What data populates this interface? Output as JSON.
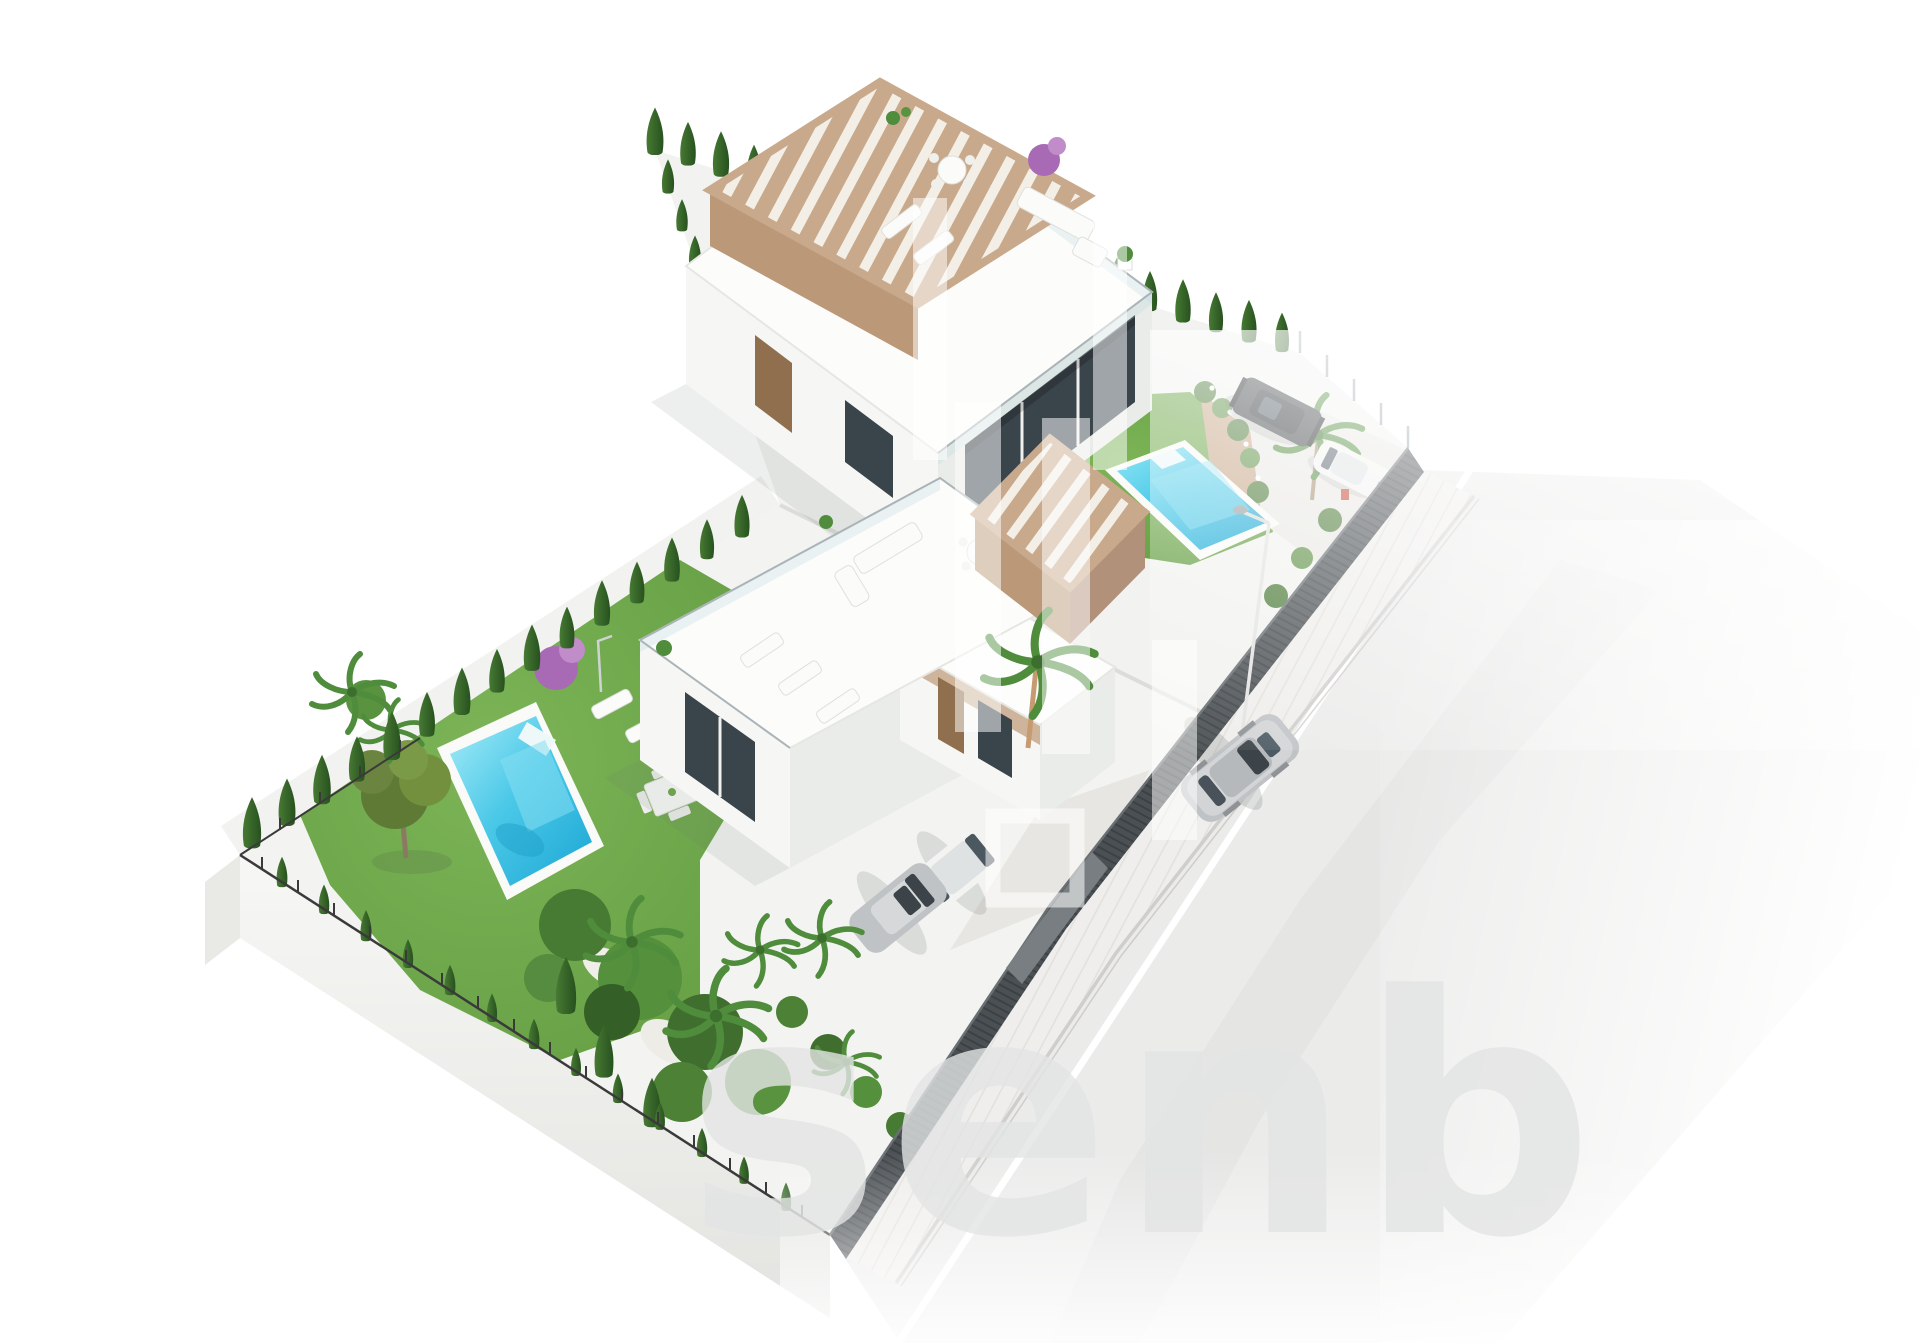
{
  "image": {
    "type": "3d-architectural-aerial-render",
    "description": "Isometric aerial render of an L-shaped plot with two modern white villas, each with roof terrace and wooden pergola, private pools, green lawns, cypress hedges, parked cars and a street running along the plot",
    "width": 1920,
    "height": 1343
  },
  "watermark": {
    "visible_letters": "senb"
  },
  "colors": {
    "background": "#ffffff",
    "lawn": "#6fa84a",
    "lawn_dark": "#5c913b",
    "pool_water": "#3fc4e6",
    "pool_water_deep": "#1ba6d4",
    "pool_deck": "#fafaf8",
    "cypress": "#2f5b28",
    "cypress_light": "#477a33",
    "pergola_beige": "#c8a98b",
    "pergola_fascia": "#bb9878",
    "pergola_fascia_light": "#d6bb9e",
    "wall_white": "#f6f6f4",
    "wall_shade": "#eaece9",
    "glass_dark": "#3a444b",
    "wood_door": "#8f6f4e",
    "accent_beige": "#cdb49a",
    "road_asphalt": "#ebebea",
    "sidewalk": "#efeeec",
    "curb": "#d6d5d1",
    "lane_line": "#ffffff",
    "fence_dark": "#4b5054",
    "gate_gray": "#797e82",
    "car_silver": "#c0c3c6",
    "car_white": "#f3f3f2",
    "car_dark": "#3e4347",
    "tan_wall": "#c9a98b",
    "olive_green": "#5e7a34",
    "palm_green": "#4f8c3c",
    "shrub_green": "#4e7d3a",
    "furniture_wood_orange": "#b5743c",
    "furniture_white": "#fbfbfa",
    "retaining_wall": "#f4f4f2",
    "metal_fence_dark": "#3a3a3a",
    "woman_dress": "#7f9c52",
    "bougainvillea": "#a86ab4",
    "watermark_gray": "#e3e5e4",
    "ground_pale": "#f2f2f0"
  },
  "scene": {
    "plots": [
      {
        "name": "upper plot",
        "features": [
          "two-storey villa",
          "roof terrace with pergola",
          "ground terrace",
          "lawn",
          "pool",
          "parking corner with two cars",
          "cypress hedge"
        ]
      },
      {
        "name": "lower plot",
        "features": [
          "two-storey villa",
          "roof terrace with pergola",
          "garden terrace",
          "large lawn",
          "pool",
          "olive tree",
          "palm garden",
          "driveway with two cars"
        ]
      }
    ],
    "pools": [
      {
        "name": "upper pool",
        "color_note": "turquoise with white deck"
      },
      {
        "name": "lower pool",
        "color_note": "turquoise with white deck"
      }
    ],
    "cars": [
      {
        "name": "silver sedan driving on road"
      },
      {
        "name": "white car in driveway"
      },
      {
        "name": "silver car in driveway"
      },
      {
        "name": "dark SUV parked at upper plot corner"
      },
      {
        "name": "white car parked at upper plot corner"
      }
    ],
    "road": {
      "elements": [
        "asphalt",
        "white center line",
        "sidewalk with paving joints",
        "street lamp",
        "dark slatted boundary fence"
      ]
    },
    "people": [
      {
        "name": "woman standing on lower garden terrace"
      }
    ]
  }
}
